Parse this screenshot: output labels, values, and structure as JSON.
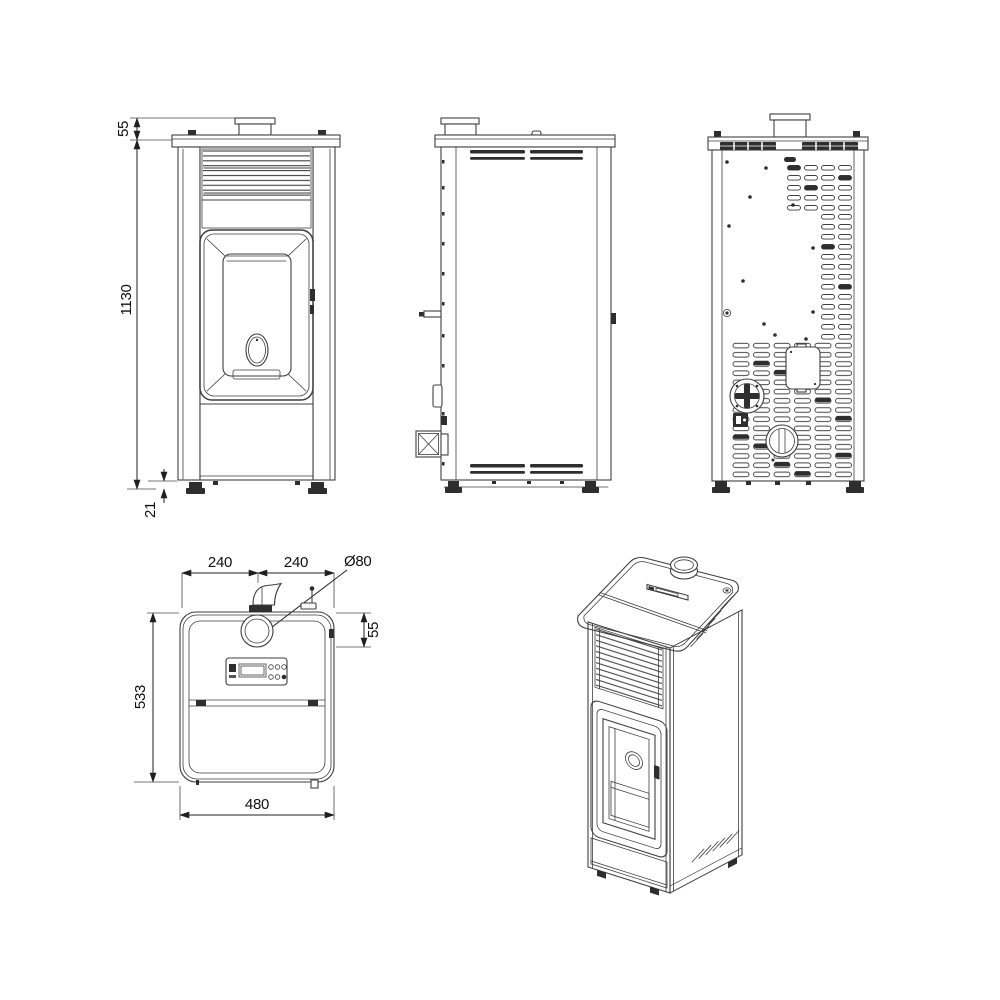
{
  "colors": {
    "line": "#3f3f3f",
    "dark_fill": "#2e2e2e",
    "dim_line": "#1f1f1f",
    "background": "#ffffff"
  },
  "dimensions": {
    "front_view": {
      "flue_collar_height": "55",
      "overall_height": "1130",
      "foot_clearance": "21"
    },
    "top_view": {
      "flue_left": "240",
      "flue_right": "240",
      "flue_diameter": "Ø80",
      "flue_offset": "55",
      "depth": "533",
      "width": "480"
    }
  }
}
